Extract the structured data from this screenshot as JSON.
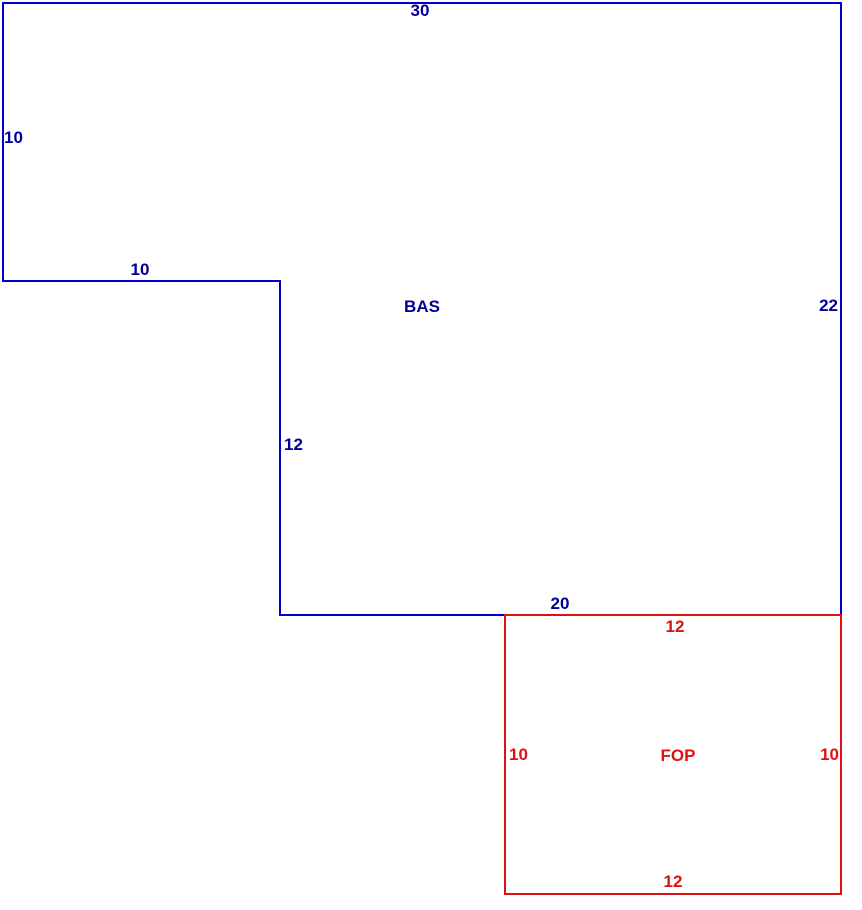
{
  "page": {
    "background": "#ffffff",
    "width": 862,
    "height": 910
  },
  "sketch": {
    "description": "Property sketch with two area outlines",
    "areas": [
      {
        "code": "BAS",
        "shape": "L-shaped polygon (notch cut from lower-left)",
        "line_color": "#0000cc",
        "text_color": "#000099",
        "dims": {
          "top": "30",
          "left": "10",
          "step_h": "10",
          "step_v": "12",
          "bottom": "20",
          "right": "22"
        }
      },
      {
        "code": "FOP",
        "shape": "rectangle attached below-right of BAS",
        "line_color": "#e01010",
        "text_color": "#dd1111",
        "dims": {
          "top": "12",
          "left": "10",
          "right": "10",
          "bottom": "12"
        }
      }
    ]
  }
}
